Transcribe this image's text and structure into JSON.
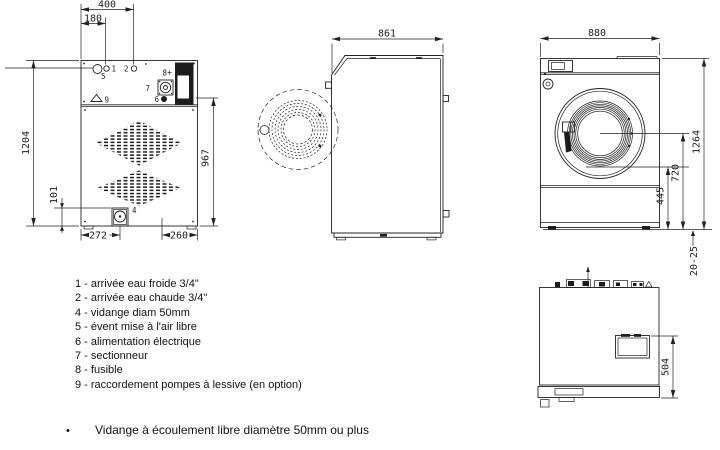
{
  "drawing": {
    "dims": {
      "back_width": "400",
      "back_inlet_offset": "180",
      "back_height": "1204",
      "drain_height": "101",
      "connection_height": "967",
      "drain_offset": "272",
      "cable_offset": "260",
      "depth": "861",
      "front_width": "880",
      "door_bottom_height": "445",
      "door_center_height": "720",
      "total_height": "1264",
      "feet_adjust": "20-25",
      "panel_depth": "504"
    },
    "callouts": {
      "cold_water": "1",
      "hot_water": "2",
      "drain": "4",
      "vent": "5",
      "power": "6",
      "switch": "7",
      "fuse": "8",
      "soap_pump": "9"
    }
  },
  "legend": {
    "items": [
      "1 - arrivée eau froide 3/4\"",
      "2 - arrivée eau chaude 3/4\"",
      "4 - vidange diam 50mm",
      "5 - évent mise à l'air libre",
      "6 - alimentation électrique",
      "7 - sectionneur",
      "8 - fusible",
      "9 - raccordement pompes à lessive (en option)"
    ]
  },
  "footnote": {
    "marker": "•",
    "text": "Vidange à écoulement libre diamètre 50mm ou plus"
  }
}
